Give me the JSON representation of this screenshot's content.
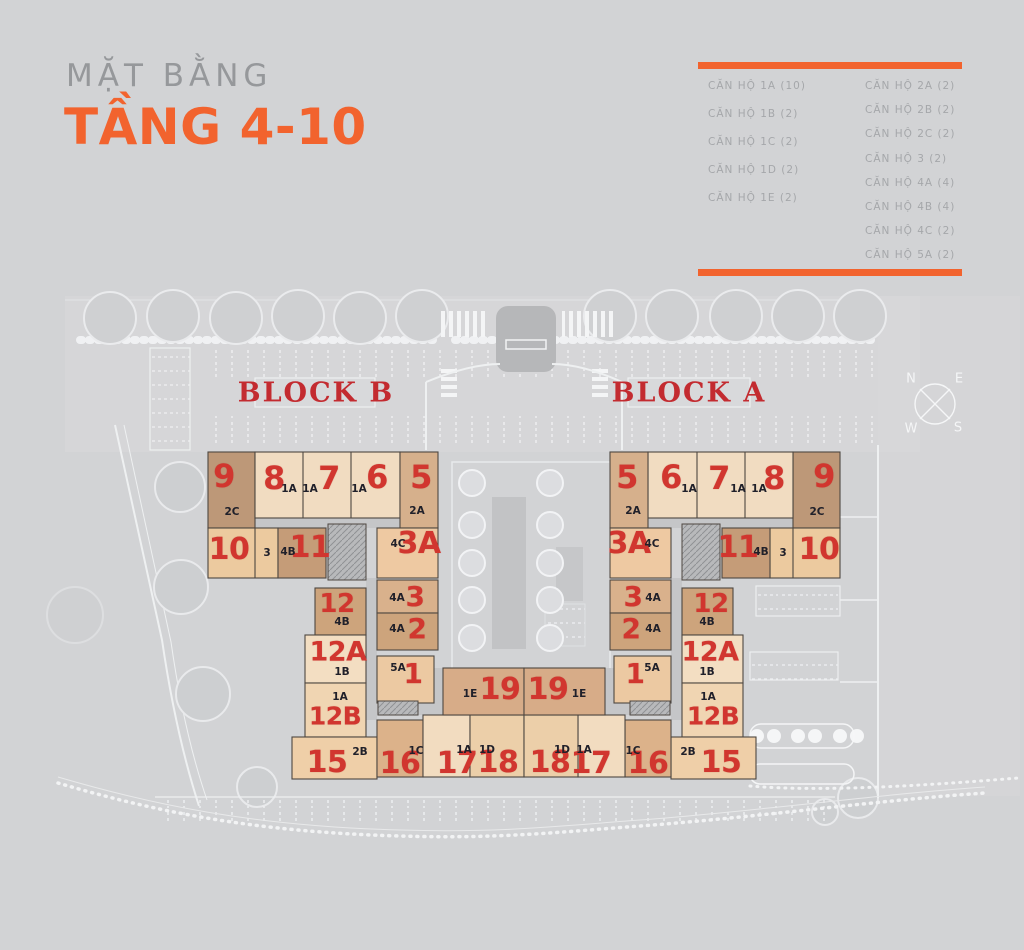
{
  "header": {
    "subtitle": "MẶT BẰNG",
    "title": "TẦNG 4-10"
  },
  "legend": {
    "left": [
      "CĂN HỘ 1A (10)",
      "CĂN HỘ 1B (2)",
      "CĂN HỘ 1C (2)",
      "CĂN HỘ 1D (2)",
      "CĂN HỘ 1E (2)"
    ],
    "right": [
      "CĂN HỘ 2A (2)",
      "CĂN HỘ 2B (2)",
      "CĂN HỘ 2C (2)",
      "CĂN HỘ 3 (2)",
      "CĂN HỘ 4A (4)",
      "CĂN HỘ 4B (4)",
      "CĂN HỘ 4C (2)",
      "CĂN HỘ 5A (2)"
    ]
  },
  "colors": {
    "accent": "#f2632e",
    "unit_number_red": "#d1362f",
    "block_label_red": "#c32b30"
  },
  "plan": {
    "blocks": [
      {
        "label": "BLOCK B"
      },
      {
        "label": "BLOCK A"
      }
    ],
    "compass": {
      "n": "N",
      "e": "E",
      "w": "W",
      "s": "S"
    },
    "unit_numbers": [
      {
        "t": "9",
        "x": 224,
        "y": 476,
        "s": 32
      },
      {
        "t": "8",
        "x": 274,
        "y": 478,
        "s": 32
      },
      {
        "t": "7",
        "x": 329,
        "y": 478,
        "s": 32
      },
      {
        "t": "6",
        "x": 377,
        "y": 477,
        "s": 32
      },
      {
        "t": "5",
        "x": 421,
        "y": 477,
        "s": 32
      },
      {
        "t": "10",
        "x": 229,
        "y": 550,
        "s": 30
      },
      {
        "t": "11",
        "x": 310,
        "y": 548,
        "s": 30
      },
      {
        "t": "3A",
        "x": 419,
        "y": 544,
        "s": 30
      },
      {
        "t": "3",
        "x": 415,
        "y": 597,
        "s": 28
      },
      {
        "t": "2",
        "x": 417,
        "y": 629,
        "s": 28
      },
      {
        "t": "1",
        "x": 413,
        "y": 674,
        "s": 28
      },
      {
        "t": "12",
        "x": 337,
        "y": 604,
        "s": 26
      },
      {
        "t": "12A",
        "x": 338,
        "y": 652,
        "s": 27
      },
      {
        "t": "12B",
        "x": 335,
        "y": 716,
        "s": 25
      },
      {
        "t": "15",
        "x": 327,
        "y": 763,
        "s": 30
      },
      {
        "t": "16",
        "x": 400,
        "y": 764,
        "s": 30
      },
      {
        "t": "17",
        "x": 457,
        "y": 764,
        "s": 30
      },
      {
        "t": "18",
        "x": 498,
        "y": 763,
        "s": 30
      },
      {
        "t": "19",
        "x": 500,
        "y": 690,
        "s": 30
      },
      {
        "t": "5",
        "x": 627,
        "y": 477,
        "s": 32
      },
      {
        "t": "6",
        "x": 671,
        "y": 477,
        "s": 32
      },
      {
        "t": "7",
        "x": 719,
        "y": 478,
        "s": 32
      },
      {
        "t": "8",
        "x": 774,
        "y": 478,
        "s": 32
      },
      {
        "t": "9",
        "x": 824,
        "y": 476,
        "s": 32
      },
      {
        "t": "3A",
        "x": 629,
        "y": 544,
        "s": 30
      },
      {
        "t": "11",
        "x": 738,
        "y": 548,
        "s": 30
      },
      {
        "t": "10",
        "x": 819,
        "y": 550,
        "s": 30
      },
      {
        "t": "3",
        "x": 633,
        "y": 597,
        "s": 28
      },
      {
        "t": "2",
        "x": 631,
        "y": 629,
        "s": 28
      },
      {
        "t": "1",
        "x": 635,
        "y": 674,
        "s": 28
      },
      {
        "t": "12",
        "x": 711,
        "y": 604,
        "s": 26
      },
      {
        "t": "12A",
        "x": 710,
        "y": 652,
        "s": 27
      },
      {
        "t": "12B",
        "x": 713,
        "y": 716,
        "s": 25
      },
      {
        "t": "15",
        "x": 721,
        "y": 763,
        "s": 30
      },
      {
        "t": "16",
        "x": 648,
        "y": 764,
        "s": 30
      },
      {
        "t": "17",
        "x": 591,
        "y": 764,
        "s": 30
      },
      {
        "t": "18",
        "x": 550,
        "y": 763,
        "s": 30
      },
      {
        "t": "19",
        "x": 548,
        "y": 690,
        "s": 30
      }
    ],
    "unit_types": [
      {
        "t": "1A",
        "x": 289,
        "y": 489
      },
      {
        "t": "1A",
        "x": 310,
        "y": 489
      },
      {
        "t": "1A",
        "x": 359,
        "y": 489
      },
      {
        "t": "2C",
        "x": 232,
        "y": 512
      },
      {
        "t": "2A",
        "x": 417,
        "y": 511
      },
      {
        "t": "3",
        "x": 267,
        "y": 553
      },
      {
        "t": "4B",
        "x": 288,
        "y": 552
      },
      {
        "t": "4C",
        "x": 398,
        "y": 544
      },
      {
        "t": "4A",
        "x": 397,
        "y": 598
      },
      {
        "t": "4A",
        "x": 397,
        "y": 629
      },
      {
        "t": "5A",
        "x": 398,
        "y": 668
      },
      {
        "t": "4B",
        "x": 342,
        "y": 622
      },
      {
        "t": "1B",
        "x": 342,
        "y": 672
      },
      {
        "t": "1A",
        "x": 340,
        "y": 697
      },
      {
        "t": "2B",
        "x": 360,
        "y": 752
      },
      {
        "t": "1C",
        "x": 416,
        "y": 751
      },
      {
        "t": "1A",
        "x": 464,
        "y": 750
      },
      {
        "t": "1D",
        "x": 487,
        "y": 750
      },
      {
        "t": "1E",
        "x": 470,
        "y": 694
      },
      {
        "t": "1A",
        "x": 759,
        "y": 489
      },
      {
        "t": "1A",
        "x": 738,
        "y": 489
      },
      {
        "t": "1A",
        "x": 689,
        "y": 489
      },
      {
        "t": "2C",
        "x": 817,
        "y": 512
      },
      {
        "t": "2A",
        "x": 633,
        "y": 511
      },
      {
        "t": "3",
        "x": 783,
        "y": 553
      },
      {
        "t": "4B",
        "x": 761,
        "y": 552
      },
      {
        "t": "4C",
        "x": 652,
        "y": 544
      },
      {
        "t": "4A",
        "x": 653,
        "y": 598
      },
      {
        "t": "4A",
        "x": 653,
        "y": 629
      },
      {
        "t": "5A",
        "x": 652,
        "y": 668
      },
      {
        "t": "4B",
        "x": 707,
        "y": 622
      },
      {
        "t": "1B",
        "x": 707,
        "y": 672
      },
      {
        "t": "1A",
        "x": 708,
        "y": 697
      },
      {
        "t": "2B",
        "x": 688,
        "y": 752
      },
      {
        "t": "1C",
        "x": 633,
        "y": 751
      },
      {
        "t": "1A",
        "x": 584,
        "y": 750
      },
      {
        "t": "1D",
        "x": 562,
        "y": 750
      },
      {
        "t": "1E",
        "x": 579,
        "y": 694
      }
    ]
  }
}
